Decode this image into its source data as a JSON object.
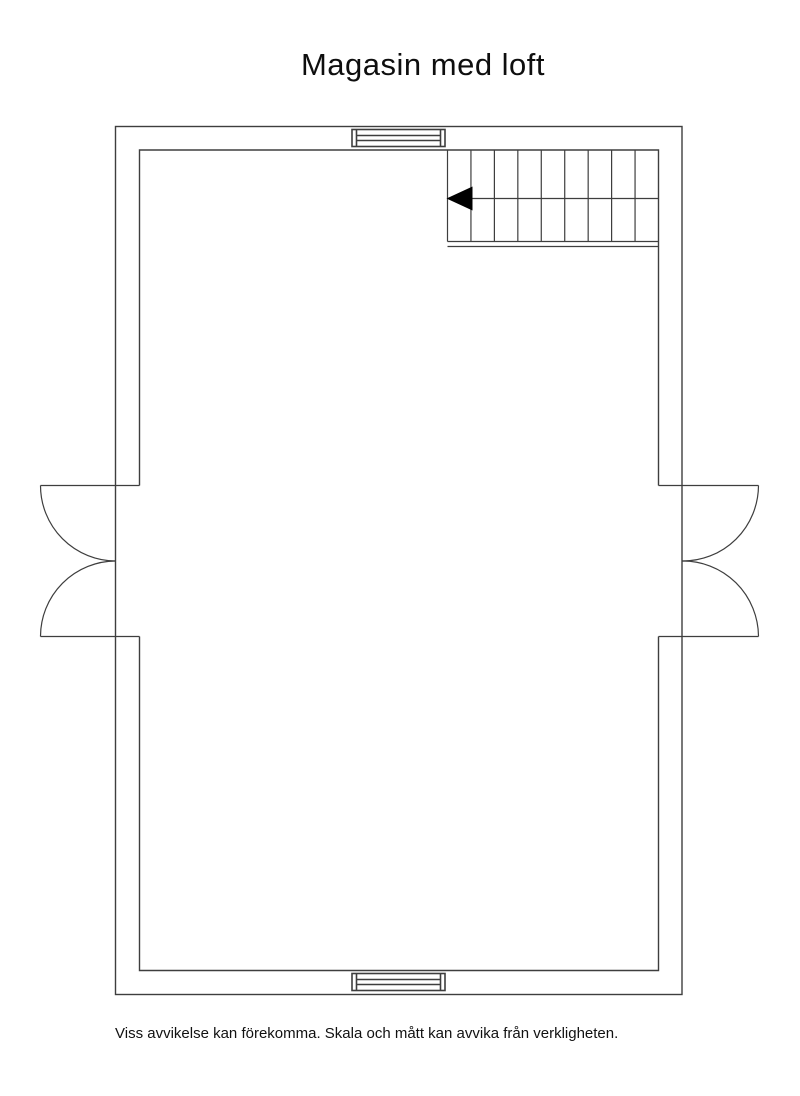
{
  "page": {
    "title": "Magasin med loft",
    "disclaimer": "Viss avvikelse kan förekomma. Skala och mått kan avvika från verkligheten."
  },
  "plan": {
    "line_color": "#3e3e3e",
    "arrow_color": "#000000",
    "stairs": {
      "step_count": 9,
      "arrow_direction": "left"
    },
    "windows": [
      {
        "position": "top-center"
      },
      {
        "position": "bottom-center"
      }
    ],
    "doors": [
      {
        "position": "left",
        "type": "double-outswing"
      },
      {
        "position": "right",
        "type": "double-outswing"
      }
    ]
  }
}
